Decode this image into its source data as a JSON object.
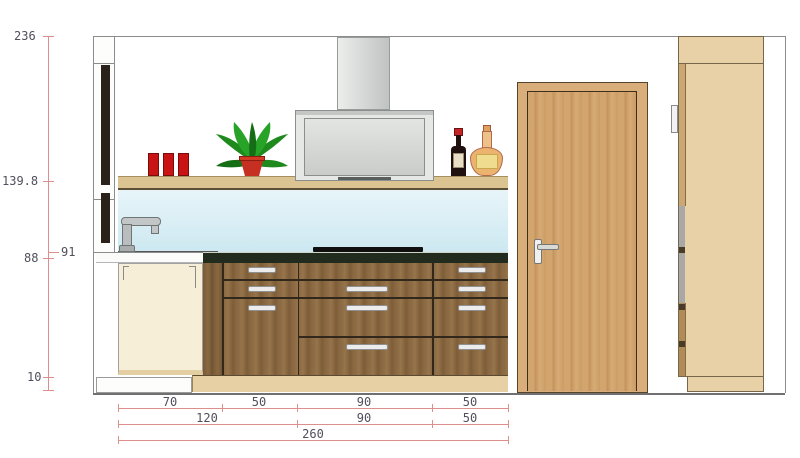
{
  "title": "Kitchen elevation drawing",
  "dims": {
    "left_labels": [
      "236",
      "139.8",
      "91",
      "88",
      "10"
    ],
    "row1": [
      "70",
      "50",
      "90",
      "50"
    ],
    "row2": [
      "120",
      "90",
      "50"
    ],
    "row3": [
      "260"
    ]
  },
  "colors": {
    "dimension_line": "#df8e8e",
    "dimension_text": "#50505c",
    "glass_backsplash": "#d7edf4",
    "countertop": "#222c1e",
    "cooktop": "#101010",
    "base_cabinet_wood": "#8a6942",
    "door_wood": "#d2a46e",
    "tall_cabinet_wood": "#e8d1a6",
    "shelf_wood": "#dbc392",
    "hood_steel": "#d9dbd9",
    "accent_red": "#c81414",
    "plant_green": "#1e8a1e",
    "cream_front": "#f7eed8"
  }
}
